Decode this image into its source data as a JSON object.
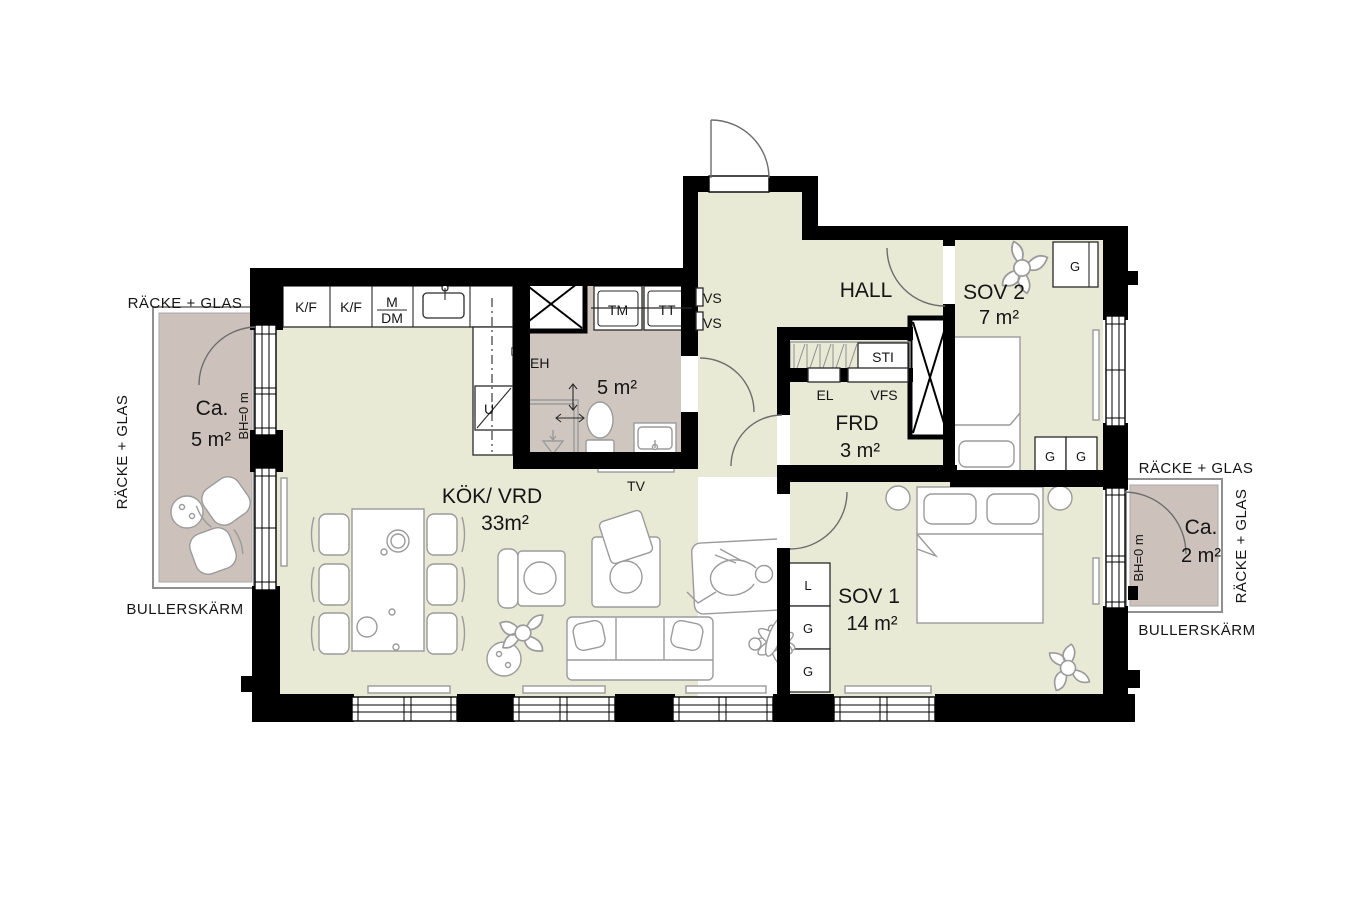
{
  "colors": {
    "wall": "#000000",
    "floor": "#e8ead6",
    "wet_floor": "#cfc6c0",
    "balcony_floor": "#ccc1bb",
    "line": "#9b9b9b"
  },
  "rooms": {
    "kok_vrd": {
      "label": "KÖK/ VRD",
      "area": "33m²"
    },
    "bathroom": {
      "area": "5 m²"
    },
    "hall": {
      "label": "HALL"
    },
    "sov1": {
      "label": "SOV 1",
      "area": "14 m²"
    },
    "sov2": {
      "label": "SOV 2",
      "area": "7 m²"
    },
    "frd": {
      "label": "FRD",
      "area": "3 m²"
    },
    "balcony_left": {
      "ca": "Ca.",
      "area": "5 m²"
    },
    "balcony_right": {
      "ca": "Ca.",
      "area": "2 m²"
    }
  },
  "annotations": {
    "racke_glas_left_top": "RÄCKE + GLAS",
    "racke_glas_left_side": "RÄCKE + GLAS",
    "racke_glas_right_top": "RÄCKE + GLAS",
    "racke_glas_right_side": "RÄCKE + GLAS",
    "bullerskarm_left": "BULLERSKÄRM",
    "bullerskarm_right": "BULLERSKÄRM",
    "bh_left": "BH=0 m",
    "bh_right": "BH=0 m"
  },
  "fixtures": {
    "kf_1": "K/F",
    "kf_2": "K/F",
    "m": "M",
    "dm": "DM",
    "u": "U",
    "tm": "TM",
    "tt": "TT",
    "vs_upper": "VS",
    "vs_lower": "VS",
    "eh": "EH",
    "tv": "TV",
    "el": "EL",
    "vfs": "VFS",
    "sti": "STI"
  },
  "wardrobes": {
    "sov2_top": "G",
    "sov2_left": "G",
    "sov2_right": "G",
    "sov1_linen": "L",
    "sov1_mid": "G",
    "sov1_bottom": "G"
  }
}
